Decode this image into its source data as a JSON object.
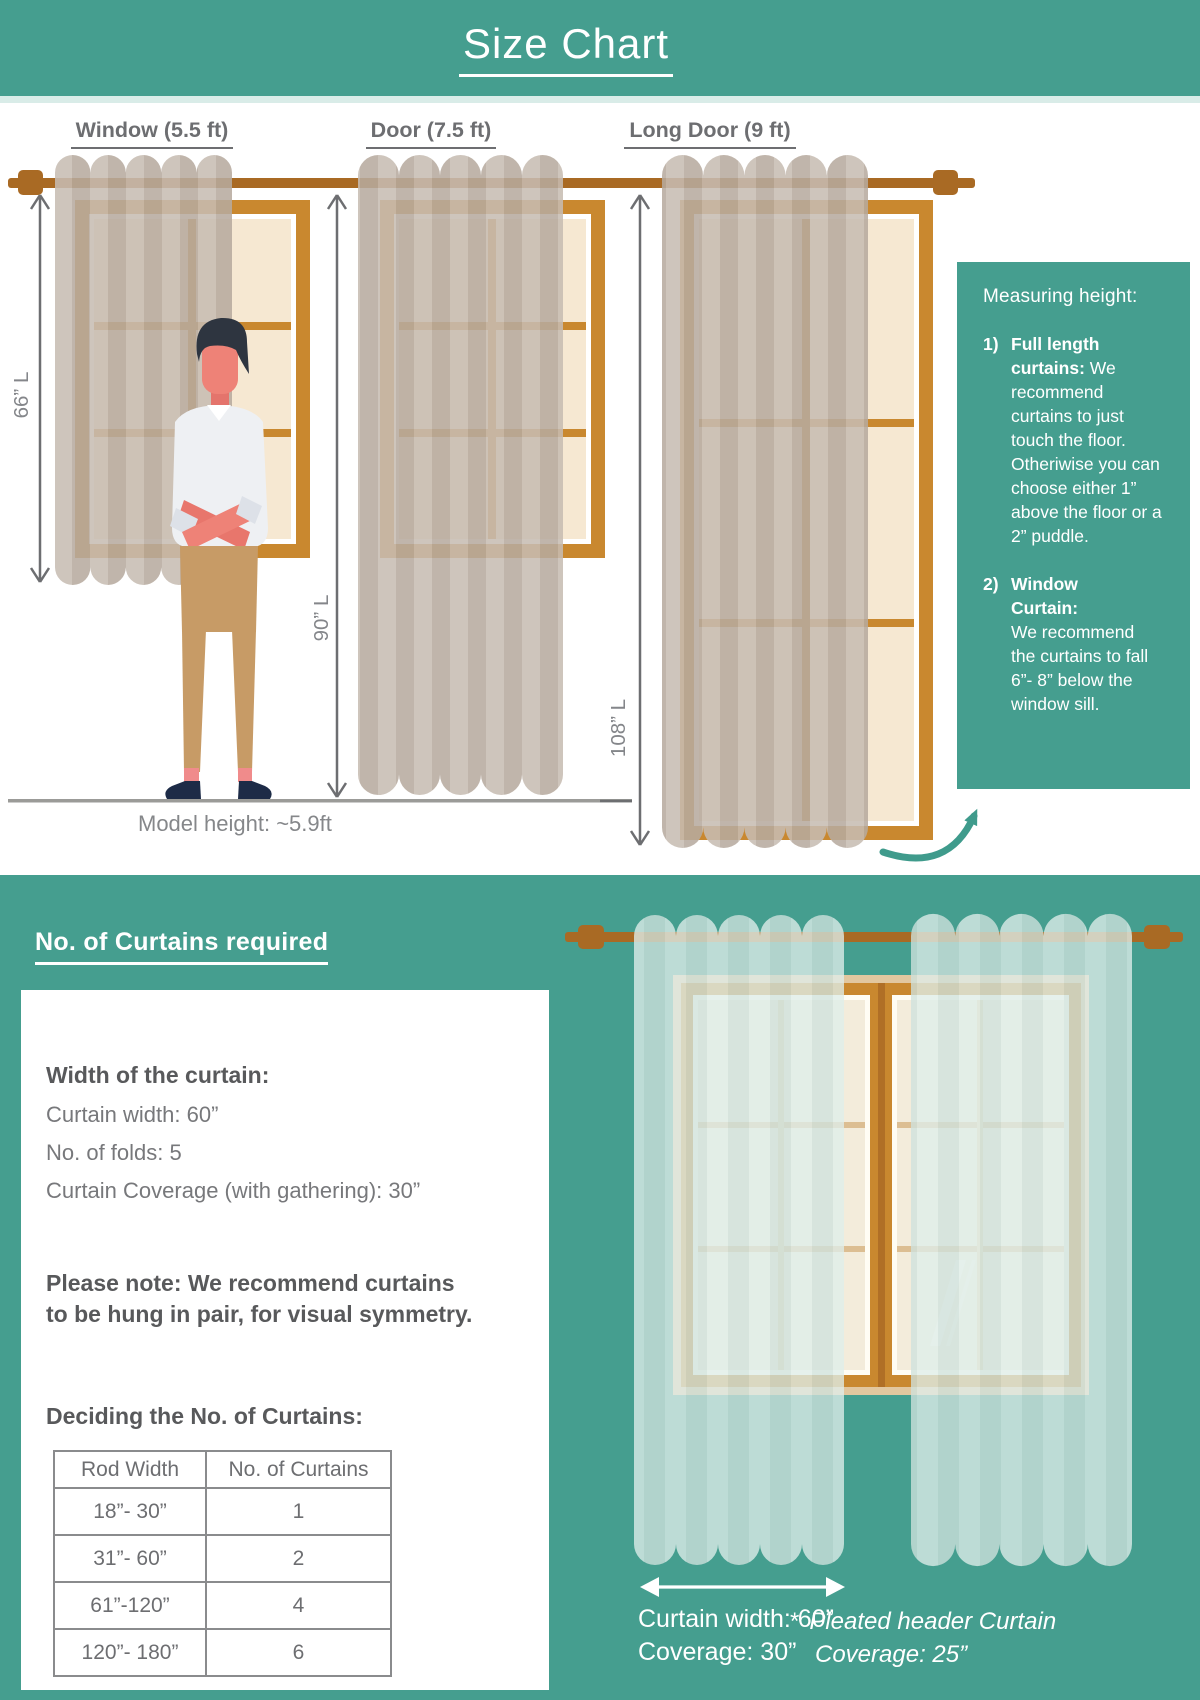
{
  "header": {
    "title": "Size Chart"
  },
  "section1": {
    "window_label": "Window (5.5 ft)",
    "door_label": "Door (7.5 ft)",
    "long_door_label": "Long Door (9 ft)",
    "window_length": "66” L",
    "door_length": "90” L",
    "long_door_length": "108” L",
    "model_caption": "Model height: ~5.9ft",
    "measuring_box": {
      "title": "Measuring height:",
      "item1_num": "1)",
      "item1_bold": "Full length curtains:",
      "item1_text": " We recommend curtains to just touch the floor. Otheriwise you can choose either 1” above the floor or a 2” puddle.",
      "item2_num": "2)",
      "item2_bold_line1": "Window",
      "item2_bold_line2": "Curtain:",
      "item2_text": "We recommend the curtains to fall 6”- 8” below the window sill."
    }
  },
  "section2": {
    "heading": "No. of Curtains required",
    "width_block": {
      "title": "Width of the curtain:",
      "line1": "Curtain width: 60”",
      "line2": "No. of folds: 5",
      "line3": "Curtain Coverage (with gathering): 30”"
    },
    "note": "Please note: We recommend curtains to be hung in pair, for visual symmetry.",
    "table_title": "Deciding the No. of Curtains:",
    "table": {
      "headers": [
        "Rod Width",
        "No. of Curtains"
      ],
      "rows": [
        [
          "18”- 30”",
          "1"
        ],
        [
          "31”- 60”",
          "2"
        ],
        [
          "61”-120”",
          "4"
        ],
        [
          "120”- 180”",
          "6"
        ]
      ]
    },
    "curtain_caption_line1": "Curtain width: 60”",
    "curtain_caption_line2": "Coverage: 30”",
    "pleated_star": "*",
    "pleated_line1": "Pleated header Curtain",
    "pleated_line2": "Coverage: 25”"
  },
  "colors": {
    "teal": "#459e8f",
    "rod_brown": "#a96a24",
    "frame_orange": "#c9882f",
    "pane_cream": "#f6e8d2",
    "curtain_taupe": "#b7aa9e",
    "sheer_mint": "#cfe2dd",
    "text_gray": "#6d6e71"
  }
}
